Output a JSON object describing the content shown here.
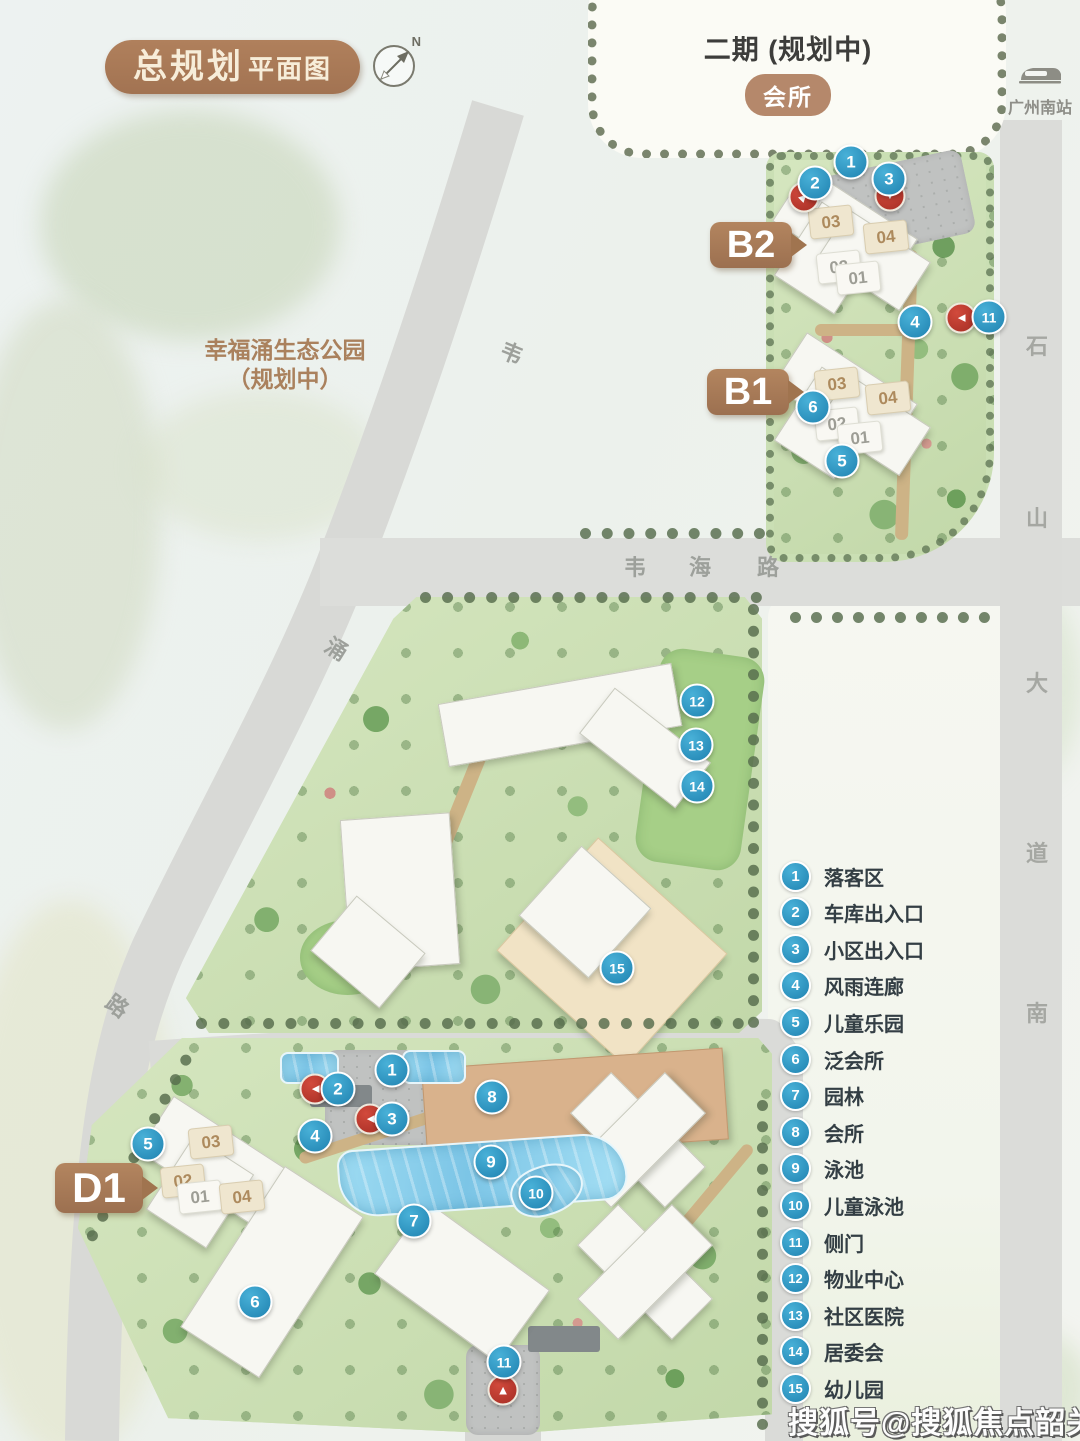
{
  "title": {
    "main": "总规划",
    "sub": "平面图"
  },
  "compass": {
    "north": "N"
  },
  "phase2": {
    "label": "二期 (规划中)",
    "badge": "会所"
  },
  "station": {
    "label": "广州南站"
  },
  "park": {
    "line1": "幸福涌生态公园",
    "line2": "（规划中）"
  },
  "plot_pills": {
    "b2": "B2",
    "b1": "B1",
    "d1": "D1"
  },
  "road_labels": {
    "weihai": "韦海路",
    "weichong": "韦涌路",
    "shishan": "石山大道南"
  },
  "legend": {
    "items": [
      {
        "num": "1",
        "label": "落客区"
      },
      {
        "num": "2",
        "label": "车库出入口"
      },
      {
        "num": "3",
        "label": "小区出入口"
      },
      {
        "num": "4",
        "label": "风雨连廊"
      },
      {
        "num": "5",
        "label": "儿童乐园"
      },
      {
        "num": "6",
        "label": "泛会所"
      },
      {
        "num": "7",
        "label": "园林"
      },
      {
        "num": "8",
        "label": "会所"
      },
      {
        "num": "9",
        "label": "泳池"
      },
      {
        "num": "10",
        "label": "儿童泳池"
      },
      {
        "num": "11",
        "label": "侧门"
      },
      {
        "num": "12",
        "label": "物业中心"
      },
      {
        "num": "13",
        "label": "社区医院"
      },
      {
        "num": "14",
        "label": "居委会"
      },
      {
        "num": "15",
        "label": "幼儿园"
      }
    ]
  },
  "map_markers": {
    "blue": [
      {
        "num": "1",
        "x": 851,
        "y": 162
      },
      {
        "num": "2",
        "x": 815,
        "y": 183
      },
      {
        "num": "3",
        "x": 889,
        "y": 179
      },
      {
        "num": "4",
        "x": 915,
        "y": 322
      },
      {
        "num": "11",
        "x": 989,
        "y": 317
      },
      {
        "num": "6",
        "x": 813,
        "y": 407
      },
      {
        "num": "5",
        "x": 842,
        "y": 461
      },
      {
        "num": "12",
        "x": 697,
        "y": 701
      },
      {
        "num": "13",
        "x": 696,
        "y": 745
      },
      {
        "num": "14",
        "x": 697,
        "y": 786
      },
      {
        "num": "15",
        "x": 617,
        "y": 968
      },
      {
        "num": "1",
        "x": 392,
        "y": 1070
      },
      {
        "num": "2",
        "x": 338,
        "y": 1089
      },
      {
        "num": "3",
        "x": 392,
        "y": 1119
      },
      {
        "num": "4",
        "x": 315,
        "y": 1136
      },
      {
        "num": "5",
        "x": 148,
        "y": 1144
      },
      {
        "num": "6",
        "x": 255,
        "y": 1302
      },
      {
        "num": "7",
        "x": 414,
        "y": 1221
      },
      {
        "num": "8",
        "x": 492,
        "y": 1097
      },
      {
        "num": "9",
        "x": 491,
        "y": 1162
      },
      {
        "num": "10",
        "x": 536,
        "y": 1193
      },
      {
        "num": "11",
        "x": 504,
        "y": 1362
      }
    ],
    "red": [
      {
        "dir": "up-right",
        "x": 804,
        "y": 197
      },
      {
        "dir": "down",
        "x": 890,
        "y": 196
      },
      {
        "dir": "left",
        "x": 961,
        "y": 318
      },
      {
        "dir": "left",
        "x": 315,
        "y": 1089
      },
      {
        "dir": "left",
        "x": 370,
        "y": 1119
      },
      {
        "dir": "up",
        "x": 503,
        "y": 1390
      }
    ]
  },
  "building_units": [
    {
      "num": "03",
      "x": 831,
      "y": 222,
      "beige": true
    },
    {
      "num": "04",
      "x": 886,
      "y": 237,
      "beige": true
    },
    {
      "num": "02",
      "x": 839,
      "y": 267,
      "beige": false
    },
    {
      "num": "01",
      "x": 858,
      "y": 278,
      "beige": false
    },
    {
      "num": "03",
      "x": 837,
      "y": 384,
      "beige": true
    },
    {
      "num": "04",
      "x": 888,
      "y": 398,
      "beige": true
    },
    {
      "num": "02",
      "x": 837,
      "y": 424,
      "beige": false
    },
    {
      "num": "01",
      "x": 860,
      "y": 438,
      "beige": false
    },
    {
      "num": "03",
      "x": 211,
      "y": 1142,
      "beige": true
    },
    {
      "num": "02",
      "x": 183,
      "y": 1181,
      "beige": true
    },
    {
      "num": "01",
      "x": 200,
      "y": 1197,
      "beige": false
    },
    {
      "num": "04",
      "x": 242,
      "y": 1197,
      "beige": true
    }
  ],
  "watermark": {
    "text": "搜狐号@搜狐焦点韶关站"
  },
  "colors": {
    "accent_brown": "#a87c5a",
    "marker_blue": "#2e9dc9",
    "marker_red": "#c23b32",
    "pool_blue": "#8fd2ee",
    "plot_green": "#c9ddb2",
    "road_gray": "#dcddda"
  }
}
